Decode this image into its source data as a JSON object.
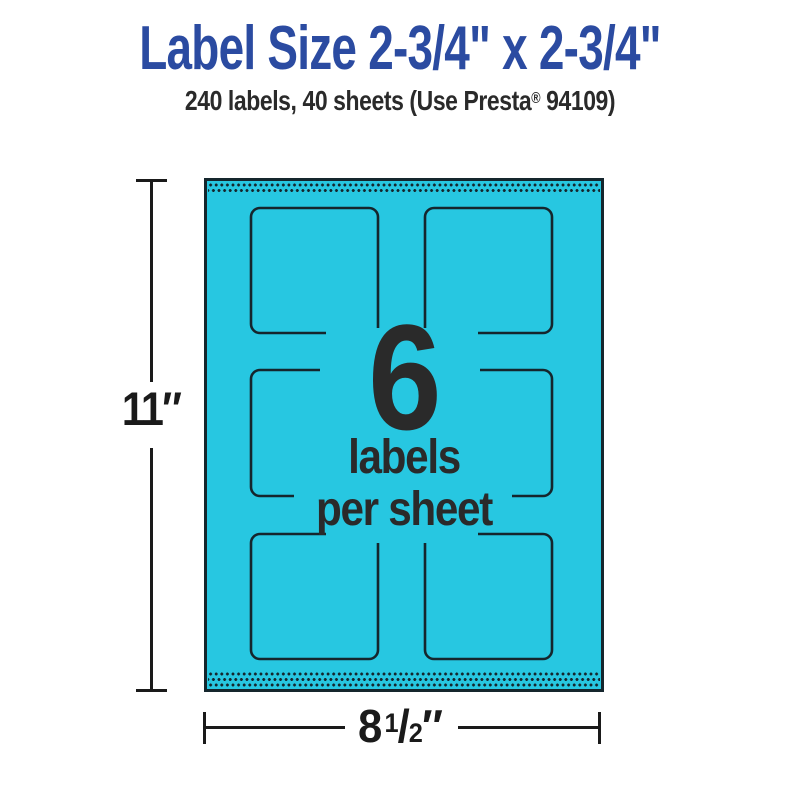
{
  "header": {
    "title": "Label Size 2-3/4\" x 2-3/4\"",
    "subtitle_prefix": "240 labels, 40 sheets (Use Presta",
    "subtitle_reg_mark": "®",
    "subtitle_suffix": " 94109)"
  },
  "diagram": {
    "sheet": {
      "labels_per_sheet": "6",
      "caption_line1": "labels",
      "caption_line2": "per sheet",
      "rows": 3,
      "columns": 2
    },
    "dimensions": {
      "height_label": "11″",
      "width_whole": "8",
      "width_numerator": "1",
      "width_slash": "/",
      "width_denominator": "2",
      "width_unit": "″"
    },
    "colors": {
      "sheet_fill": "#27C7E1",
      "outline": "#15262D",
      "title_blue": "#2B4BA1",
      "text_dark": "#2A2A2A",
      "dim_black": "#1A1A1A"
    }
  }
}
